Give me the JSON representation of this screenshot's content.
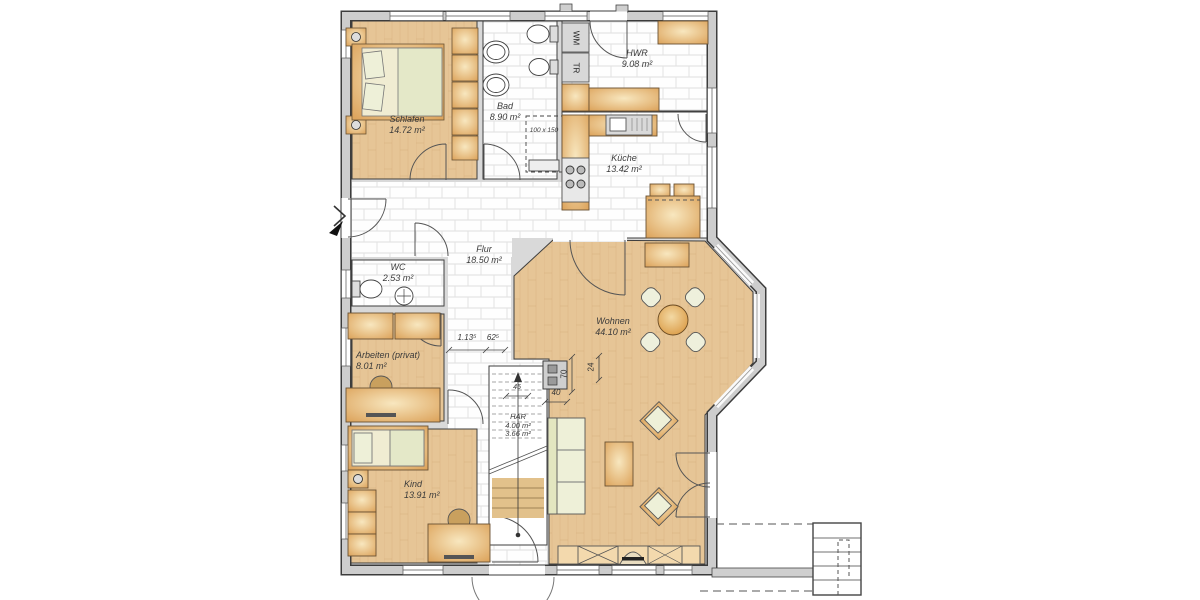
{
  "plan": {
    "rooms": [
      {
        "name": "Schlafen",
        "area": "14.72 m²"
      },
      {
        "name": "Bad",
        "area": "8.90 m²"
      },
      {
        "name": "HWR",
        "area": "9.08 m²"
      },
      {
        "name": "Küche",
        "area": "13.42 m²"
      },
      {
        "name": "Flur",
        "area": "18.50 m²"
      },
      {
        "name": "WC",
        "area": "2.53 m²"
      },
      {
        "name": "Arbeiten (privat)",
        "area": "8.01 m²"
      },
      {
        "name": "Kind",
        "area": "13.91 m²"
      },
      {
        "name": "Wohnen",
        "area": "44.10 m²"
      },
      {
        "name": "HAR",
        "area": "4.00 m²",
        "area2": "3.66 m²"
      }
    ],
    "appliances": {
      "washing_machine": "WM",
      "dryer": "TR"
    },
    "fixtures": {
      "shower_size": "100 x 150"
    },
    "dimensions": {
      "hall_a": "1.13⁵",
      "hall_b": "62⁵",
      "chimney_h": "70",
      "chimney_w": "24",
      "chimney_d": "40",
      "stair_w": "45"
    },
    "colors": {
      "wood": "#e5c091",
      "tile": "#ffffff",
      "wall_fill": "#cccccc",
      "furniture": "#e3b06c",
      "seat_pale": "#edf0d8",
      "table_wood": "#e09a40"
    }
  }
}
